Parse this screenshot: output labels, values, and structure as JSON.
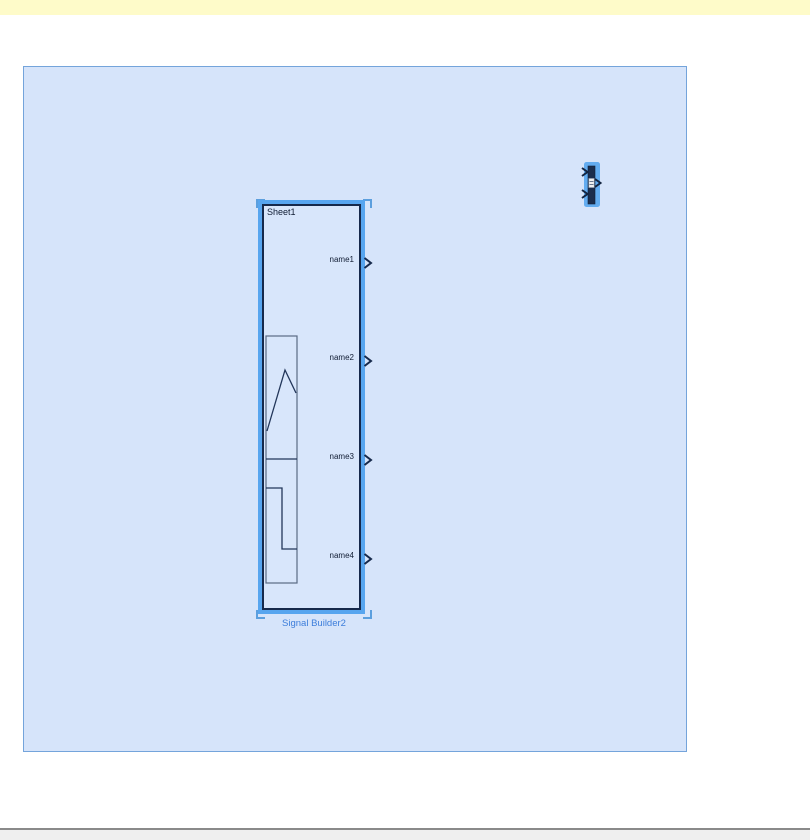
{
  "colors": {
    "notification": "#FEFBC9",
    "canvas_bg": "#D6E4FA",
    "canvas_border": "#74A4DB",
    "selection": "#57A5EF",
    "bracket": "#5C9FDE",
    "block_border": "#16294B",
    "block_fill": "#D8E6FB",
    "icon_line": "#22365A",
    "icon_frame": "#5A6A84",
    "label_text": "#101C33",
    "caption_text": "#3D7EDB",
    "mux_fill": "#1B2D4D",
    "mux_glow": "#63ACF0",
    "statusbar_bg": "#EFEFEF",
    "statusbar_line": "#8A8A8A"
  },
  "diagram": {
    "signal_builder": {
      "sheet_label": "Sheet1",
      "caption": "Signal Builder2",
      "ports": [
        {
          "label": "name1"
        },
        {
          "label": "name2"
        },
        {
          "label": "name3"
        },
        {
          "label": "name4"
        }
      ],
      "icon_waveforms": [
        "ramp",
        "step"
      ],
      "selected": true
    },
    "mux": {
      "inputs": 2,
      "outputs": 1,
      "selected": true
    }
  }
}
